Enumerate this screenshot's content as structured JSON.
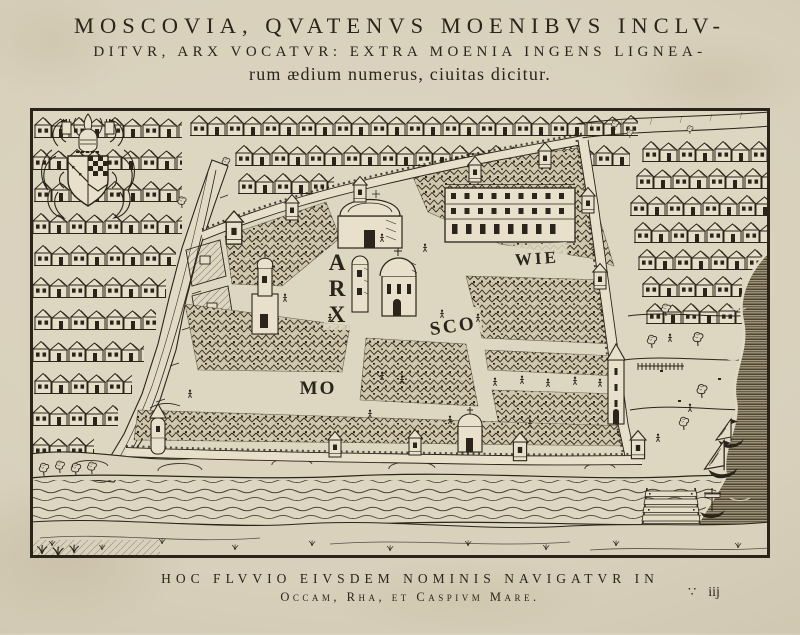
{
  "title": {
    "line1": "MOSCOVIA, QVATENVS MOENIBVS INCLV-",
    "line2": "DITVR, ARX VOCATVR: EXTRA MOENIA INGENS LIGNEA-",
    "line3": "rum ædium numerus, ciuitas dicitur."
  },
  "map": {
    "labels": {
      "arx_letters": [
        "A",
        "R",
        "X"
      ],
      "mo": "MO",
      "sco": "SCO",
      "wie": "WIE"
    }
  },
  "caption": {
    "line1": "HOC FLVVIO EIVSDEM NOMINIS NAVIGATVR IN",
    "line2": "Occam, Rha, et Caspivm Mare."
  },
  "printers_mark": {
    "dots": "∵",
    "quire": "iij"
  },
  "colors": {
    "paper": "#d8d0bb",
    "ink": "#2b241a",
    "water-line": "#4a4133",
    "dense-fill": "#cfc6ab"
  }
}
